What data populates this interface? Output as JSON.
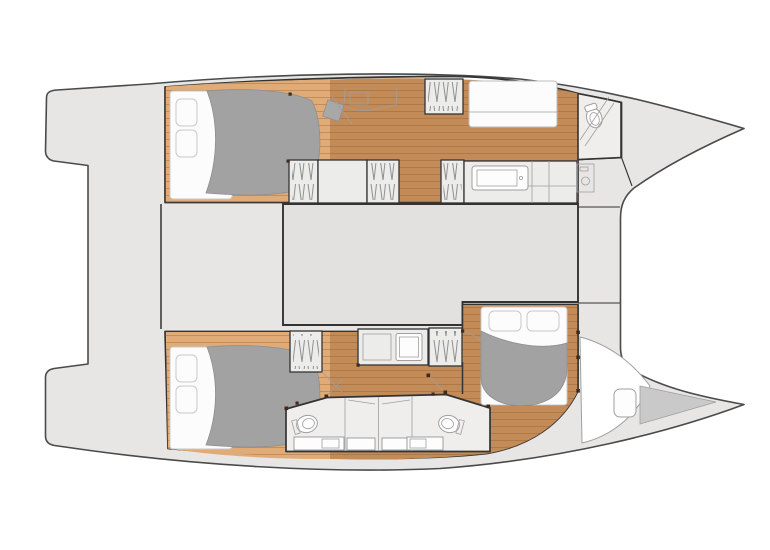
{
  "page": {
    "description": "Catamaran yacht interior floor plan, top-down view, bow pointing right, showing three double cabins, bathrooms, wardrobes, saloon block and deck platforms"
  },
  "colors": {
    "deck": "#e7e6e4",
    "deck_outline": "#4a4a4a",
    "wall": "#333333",
    "saloon": "#e2e1df",
    "hull_interior": "#ffffff",
    "wood_light": "#e1ab77",
    "wood_mid": "#d09a64",
    "wood_dark": "#c38b58",
    "plank_line": "#7d4d22",
    "bathroom_floor": "#efeeec",
    "furniture_fill": "#ececeb",
    "furniture_line": "#9f9f9f",
    "hatch_line": "#8f8f8f",
    "duvet": "#a2a2a2",
    "duvet_edge": "#8e8e8e",
    "pillow": "#fcfcfc",
    "pillow_edge": "#c8c8c8",
    "forepeak": "#c9c9c9",
    "pivot": "#3f2a1c"
  },
  "vessel_plan": {
    "type": "catamaran-interior-floor-plan",
    "orientation": "bow-right",
    "upper_hull_zones": [
      "aft-double-cabin",
      "corridor-with-desk-and-stool",
      "hatched-lockers-and-vanity",
      "forward-bathroom-with-toilet",
      "bow-locker"
    ],
    "lower_hull_zones": [
      "aft-double-cabin",
      "companionway-steps",
      "counter-with-sink",
      "twin-bathrooms-with-shower-stalls",
      "forward-double-cabin",
      "bow-berth-with-cushion"
    ],
    "center_zones": [
      "aft-transom-steps",
      "aft-platform",
      "cockpit",
      "saloon-block",
      "foredeck-band"
    ],
    "furniture": {
      "double_beds": 3,
      "toilets": 3,
      "shower_stalls": 2,
      "hatched_lockers": 6,
      "sinks": 4,
      "desk": 1,
      "stool": 1,
      "sofa_bench": 1,
      "bow_cushion": 1
    }
  }
}
